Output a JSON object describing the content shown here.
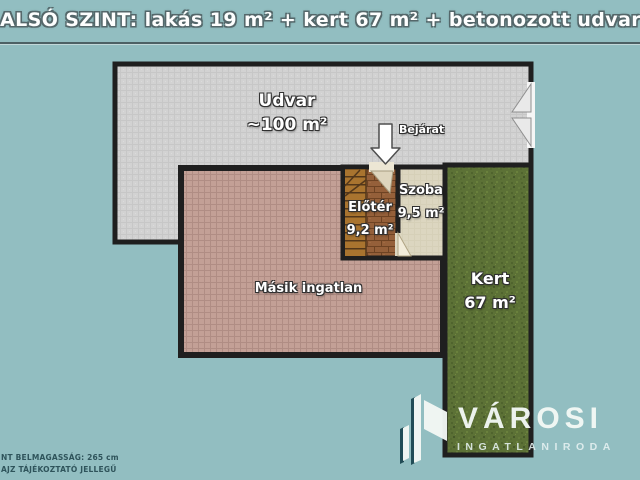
{
  "title": "ALSÓ SZINT: lakás 19 m² + kert 67 m² + betonozott udvar ~100 m²",
  "rooms": {
    "udvar": {
      "name": "Udvar",
      "area": "~100 m²"
    },
    "eloter": {
      "name": "Előtér",
      "area": "9,2 m²"
    },
    "szoba": {
      "name": "Szoba",
      "area": "9,5 m²"
    },
    "masik_ingatlan": {
      "name": "Másik ingatlan"
    },
    "kert": {
      "name": "Kert",
      "area": "67 m²"
    }
  },
  "annotations": {
    "entrance_label": "Bejárat"
  },
  "footer": {
    "line1": "NT BELMAGASSÁG: 265 cm",
    "line2": "AJZ TÁJÉKOZTATÓ JELLEGŰ"
  },
  "logo": {
    "brand": "VÁROSI",
    "tagline": "INGATLANIRODA"
  },
  "colors": {
    "background": "#92bec1",
    "wall": "#1f1f1f",
    "concrete": "#d2d2d2",
    "tile_pink": "#c3a096",
    "brick": "#95603a",
    "room_floor": "#dcd6c0",
    "grass": "#5c7136",
    "label_text": "#ffffff",
    "note_text": "#2f545b",
    "logo_text": "#f3f8f5"
  }
}
